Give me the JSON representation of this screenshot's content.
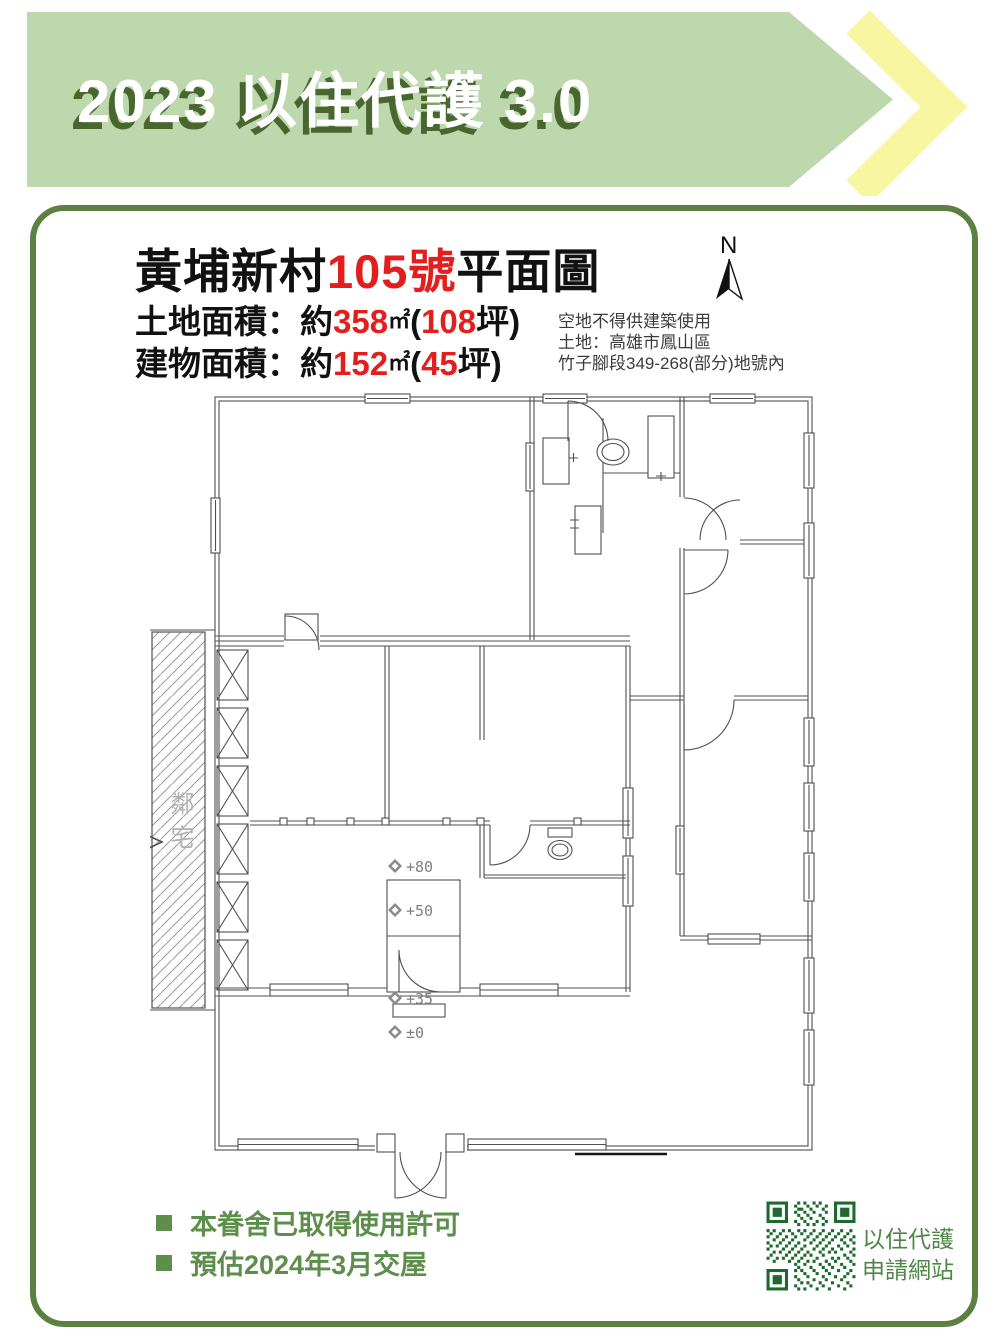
{
  "banner": {
    "title": "2023 以住代護 3.0"
  },
  "heading": {
    "prefix": "黃埔新村",
    "number": "105號",
    "suffix": "平面圖"
  },
  "areas": [
    {
      "label": "土地面積：約",
      "sqm": "358",
      "sqm_unit": "㎡",
      "open_paren": "(",
      "tsubo": "108",
      "close_paren": "坪)"
    },
    {
      "label": "建物面積：約",
      "sqm": "152",
      "sqm_unit": "㎡",
      "open_paren": "(",
      "tsubo": "45",
      "close_paren": "坪)"
    }
  ],
  "site_note": {
    "line1": "空地不得供建築使用",
    "line2": "土地：高雄市鳳山區",
    "line3": "竹子腳段349-268(部分)地號內"
  },
  "compass": {
    "label": "N"
  },
  "plan": {
    "neighbor_label": "鄰宅",
    "levels": [
      "+80",
      "+50",
      "+35",
      "±0"
    ]
  },
  "footer": {
    "bullets": [
      "本眷舍已取得使用許可",
      "預估2024年3月交屋"
    ],
    "qr_caption1": "以住代護",
    "qr_caption2": "申請網站"
  },
  "colors": {
    "banner_green": "#bed8ae",
    "shadow_green": "#47672f",
    "accent_yellow": "#f9f6a1",
    "border_green": "#5a8142",
    "highlight_red": "#e31e1e",
    "text_green": "#5d8e4b",
    "qr_green": "#1d6a2f"
  }
}
